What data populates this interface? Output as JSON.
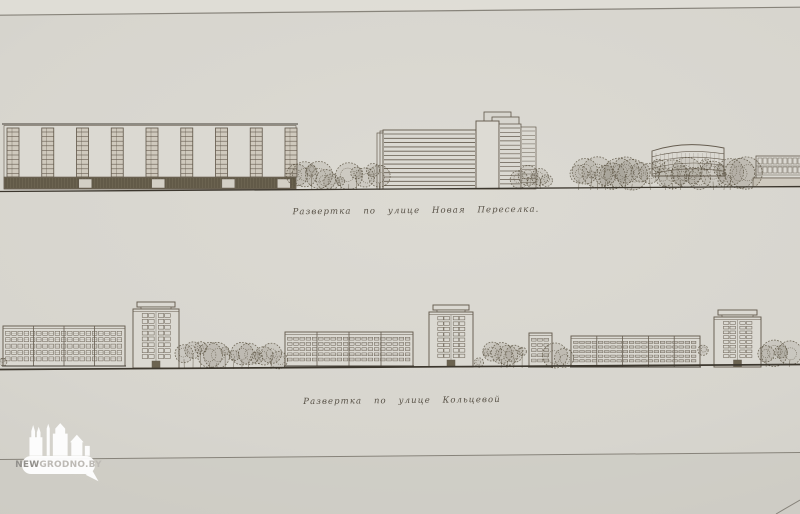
{
  "colors": {
    "paper": "#d7d5ce",
    "wall": "#dbd9d2",
    "ink": "#655c4f",
    "ink_dark": "#443f36",
    "base_dark": "#6b6350",
    "tree": "#5c5443",
    "ground": "#3c372e",
    "sheet_line": "#7f7b72",
    "watermark_white": "#ffffff",
    "wm_text_bold": "#8f8d89",
    "wm_text_light": "#bdbab5"
  },
  "watermark": {
    "brand_bold": "NEW",
    "brand_rest": "GRODNO.BY",
    "logo": "grodno-skyline-icon"
  },
  "sheet_lines": [
    {
      "x1": 0,
      "y1": 15.2,
      "x2": 800,
      "y2": 7.2,
      "w": 1.2
    },
    {
      "x1": 0,
      "y1": 459.5,
      "x2": 800,
      "y2": 452.5,
      "w": 1.0
    },
    {
      "x1": 776,
      "y1": 514,
      "x2": 800,
      "y2": 500,
      "w": 1.0
    }
  ],
  "elevations": [
    {
      "name": "elevation-ulitsa-novaya-pereselka",
      "caption": "Развертка по улице Новая Переселка.",
      "caption_x": 416,
      "caption_y": 206,
      "ground": {
        "x1": 0,
        "y1": 191.5,
        "x2": 800,
        "y2": 186.5,
        "w": 1.3
      },
      "buildings": [
        {
          "type": "strip-slab",
          "name": "slab-with-stair-strips",
          "x": 4,
          "w": 292,
          "top": 124,
          "bottom": 189,
          "base_top": 177,
          "strips": 9
        },
        {
          "type": "ribbon-complex",
          "name": "modernist-stepped-building",
          "x": 377,
          "ground": 189
        },
        {
          "type": "curved-block",
          "name": "curved-building",
          "x": 652,
          "w": 72,
          "top": 142,
          "bottom": 176
        },
        {
          "type": "low-band",
          "name": "low-building",
          "x": 756,
          "w": 46,
          "top": 156,
          "bottom": 187
        }
      ],
      "trees": [
        {
          "x": 294,
          "w": 90,
          "top": 161,
          "bottom": 190
        },
        {
          "x": 516,
          "w": 38,
          "top": 165,
          "bottom": 189
        },
        {
          "x": 576,
          "w": 176,
          "top": 156,
          "bottom": 190
        }
      ]
    },
    {
      "name": "elevation-ulitsa-koltsevaya",
      "caption": "Развертка по улице Кольцевой",
      "caption_x": 402,
      "caption_y": 396,
      "ground": {
        "x1": 0,
        "y1": 369.5,
        "x2": 800,
        "y2": 364.5,
        "w": 1.7
      },
      "buildings": [
        {
          "type": "grid-slab",
          "name": "five-story-slab",
          "x": 3,
          "w": 122,
          "top": 326,
          "bottom": 366,
          "floors": 5,
          "sections": 4
        },
        {
          "type": "tower",
          "name": "nine-story-tower",
          "x": 131,
          "w": 50,
          "cap_top": 302,
          "body_top": 309,
          "bottom": 368
        },
        {
          "type": "grid-slab",
          "name": "five-story-slab",
          "x": 285,
          "w": 128,
          "top": 332,
          "bottom": 366,
          "floors": 5,
          "sections": 4
        },
        {
          "type": "tower",
          "name": "nine-story-tower",
          "x": 427,
          "w": 48,
          "cap_top": 305,
          "body_top": 312,
          "bottom": 367
        },
        {
          "type": "grid-slab",
          "name": "five-story-slab-small",
          "x": 529,
          "w": 23,
          "top": 333,
          "bottom": 367,
          "floors": 5,
          "sections": 1
        },
        {
          "type": "grid-slab",
          "name": "five-story-slab",
          "x": 571,
          "w": 129,
          "top": 336,
          "bottom": 367,
          "floors": 5,
          "sections": 5
        },
        {
          "type": "tower",
          "name": "nine-story-tower",
          "x": 712,
          "w": 51,
          "cap_top": 310,
          "body_top": 317,
          "bottom": 367
        }
      ],
      "trees": [
        {
          "x": 0,
          "w": 13,
          "top": 331,
          "bottom": 369
        },
        {
          "x": 181,
          "w": 103,
          "top": 340,
          "bottom": 369
        },
        {
          "x": 476,
          "w": 53,
          "top": 340,
          "bottom": 368
        },
        {
          "x": 552,
          "w": 19,
          "top": 343,
          "bottom": 368
        },
        {
          "x": 700,
          "w": 12,
          "top": 343,
          "bottom": 367
        },
        {
          "x": 763,
          "w": 37,
          "top": 340,
          "bottom": 367
        }
      ]
    }
  ]
}
